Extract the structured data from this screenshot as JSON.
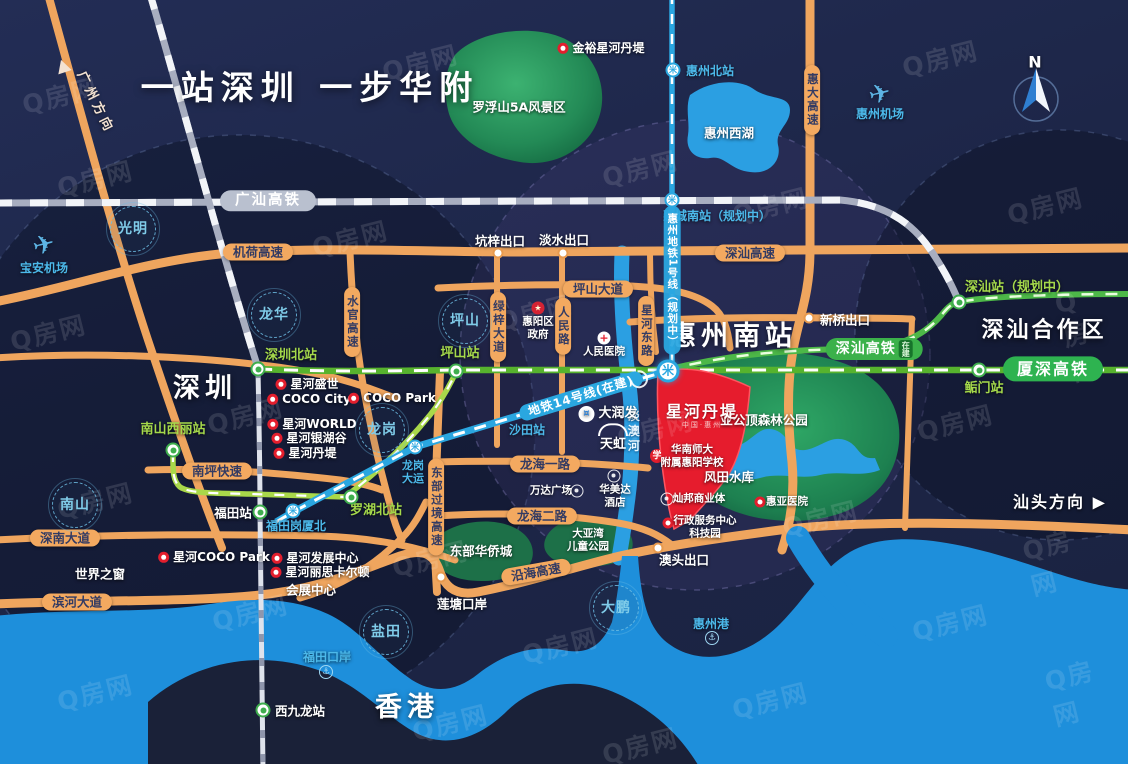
{
  "palette": {
    "background_navy": "#1d2648",
    "water_blue": "#1e8fdb",
    "land_dark": "#1a2138",
    "green_park": "#2e9e63",
    "road_orange": "#f3a960",
    "rail_gray": "#b9c0cf",
    "hsr_green": "#3bb14a",
    "metro_blue": "#2aa7e0",
    "project_red": "#e61c2d",
    "station_green_text": "#a5d94b",
    "station_blue_text": "#4cb9ea"
  },
  "watermark": {
    "text": "Q房网",
    "positions": [
      [
        60,
        95
      ],
      [
        420,
        62
      ],
      [
        940,
        58
      ],
      [
        640,
        168
      ],
      [
        95,
        178
      ],
      [
        770,
        205
      ],
      [
        1045,
        205
      ],
      [
        350,
        238
      ],
      [
        535,
        312
      ],
      [
        48,
        332
      ],
      [
        1085,
        335
      ],
      [
        245,
        415
      ],
      [
        655,
        428
      ],
      [
        955,
        422
      ],
      [
        95,
        500
      ],
      [
        430,
        558
      ],
      [
        820,
        518
      ],
      [
        1060,
        560
      ],
      [
        250,
        612
      ],
      [
        560,
        645
      ],
      [
        950,
        622
      ],
      [
        95,
        692
      ],
      [
        450,
        722
      ],
      [
        770,
        700
      ],
      [
        1075,
        692
      ],
      [
        640,
        745
      ]
    ]
  },
  "labels": [
    {
      "n": "main-title",
      "t": "title",
      "x": 310,
      "y": 88,
      "s": "一站深圳 一步华附"
    },
    {
      "n": "city-shenzhen",
      "t": "city",
      "x": 205,
      "y": 389,
      "s": "深圳"
    },
    {
      "n": "city-hongkong",
      "t": "city",
      "x": 407,
      "y": 708,
      "s": "香港"
    },
    {
      "n": "station-huizhounan-title",
      "t": "city",
      "x": 733,
      "y": 337,
      "s": "惠州南站"
    },
    {
      "n": "area-shenshan-coop",
      "t": "citysm",
      "x": 1044,
      "y": 331,
      "s": "深汕合作区"
    },
    {
      "n": "poi-window-of-world",
      "t": "w",
      "x": 100,
      "y": 574,
      "s": "世界之窗"
    },
    {
      "n": "poi-convention-center",
      "t": "w",
      "x": 311,
      "y": 590,
      "s": "会展中心"
    },
    {
      "n": "dir-shantou",
      "t": "wb",
      "x": 1060,
      "y": 502,
      "s": "汕头方向 ▶"
    },
    {
      "n": "compass-n-label",
      "t": "wb",
      "x": 1036,
      "y": 62,
      "s": "N"
    },
    {
      "n": "dir-guangzhou",
      "t": "dir",
      "x": 95,
      "y": 103,
      "rot": 64,
      "s": "广州方向"
    },
    {
      "n": "dir-guangzhou-arrow",
      "t": "sta",
      "ic": "tri",
      "x": 63,
      "y": 66
    },
    {
      "n": "area-luofushan",
      "t": "w",
      "x": 519,
      "y": 107,
      "s": "罗浮山5A风景区"
    },
    {
      "n": "area-yagongding",
      "t": "w",
      "x": 764,
      "y": 420,
      "s": "亚公顶森林公园"
    },
    {
      "n": "area-fengtian-reservoir",
      "t": "w",
      "x": 729,
      "y": 477,
      "s": "风田水库"
    },
    {
      "n": "area-oct-east",
      "t": "w",
      "x": 481,
      "y": 551,
      "s": "东部华侨城"
    },
    {
      "n": "area-dayawan-park",
      "t": "wsm",
      "x": 588,
      "y": 540,
      "s": "大亚湾",
      "s2": "儿童公园"
    },
    {
      "n": "lake-west-lake-label",
      "t": "w",
      "x": 729,
      "y": 133,
      "s": "惠州西湖"
    },
    {
      "n": "port-liantang-label",
      "t": "w",
      "x": 462,
      "y": 604,
      "s": "莲塘口岸"
    },
    {
      "n": "exit-kengzi-label",
      "t": "w",
      "x": 500,
      "y": 241,
      "s": "坑梓出口"
    },
    {
      "n": "exit-danshui-label",
      "t": "w",
      "x": 564,
      "y": 240,
      "s": "淡水出口"
    },
    {
      "n": "exit-xinqiao-label",
      "t": "w",
      "x": 845,
      "y": 320,
      "s": "新桥出口"
    },
    {
      "n": "exit-aotou-label",
      "t": "w",
      "x": 684,
      "y": 560,
      "s": "澳头出口"
    },
    {
      "n": "poi-renmin-hospital",
      "t": "wsm",
      "x": 604,
      "y": 352,
      "s": "人民医院"
    },
    {
      "n": "renmin-hospital-icon",
      "t": "sta",
      "ic": "cross",
      "x": 604,
      "y": 338
    },
    {
      "n": "poi-huiyang-gov",
      "t": "wsm",
      "x": 538,
      "y": 328,
      "s": "惠阳区",
      "s2": "政府"
    },
    {
      "n": "huiyang-gov-icon",
      "t": "sta",
      "ic": "gov",
      "x": 538,
      "y": 308
    },
    {
      "n": "poi-wanda-plaza",
      "t": "wsm",
      "x": 551,
      "y": 491,
      "s": "万达广场"
    },
    {
      "n": "wanda-plaza-icon",
      "t": "sta",
      "ic": "ring",
      "x": 577,
      "y": 491
    },
    {
      "n": "poi-ramada-hotel",
      "t": "wsm",
      "x": 615,
      "y": 496,
      "s": "华美达",
      "s2": "酒店"
    },
    {
      "n": "ramada-hotel-icon",
      "t": "sta",
      "ic": "ring",
      "x": 614,
      "y": 476
    },
    {
      "n": "canbang-icon",
      "t": "sta",
      "ic": "ring",
      "x": 667,
      "y": 499
    },
    {
      "n": "poi-canbang",
      "t": "wsm",
      "x": 699,
      "y": 499,
      "s": "灿邦商业体"
    },
    {
      "n": "admin-center-icon",
      "t": "sta",
      "ic": "pin",
      "x": 668,
      "y": 523
    },
    {
      "n": "poi-admin-center",
      "t": "wsm",
      "x": 705,
      "y": 527,
      "s": "行政服务中心",
      "s2": "科技园"
    },
    {
      "n": "poi-xinghe-cocopark",
      "t": "poi",
      "x": 214,
      "y": 557,
      "s": "星河COCO Park"
    },
    {
      "n": "poi-xinghe-dev-center",
      "t": "poi",
      "x": 315,
      "y": 558,
      "s": "星河发展中心"
    },
    {
      "n": "poi-xinghe-ritz",
      "t": "poi",
      "x": 320,
      "y": 572,
      "s": "星河丽思卡尔顿"
    },
    {
      "n": "poi-xinghe-shengshi",
      "t": "poi",
      "x": 307,
      "y": 384,
      "s": "星河盛世"
    },
    {
      "n": "poi-coco-city",
      "t": "poi",
      "x": 309,
      "y": 399,
      "s": "COCO City"
    },
    {
      "n": "poi-xinghe-world",
      "t": "poi",
      "x": 312,
      "y": 424,
      "s": "星河WORLD"
    },
    {
      "n": "poi-xinghe-yinhugu",
      "t": "poi",
      "x": 309,
      "y": 438,
      "s": "星河银湖谷"
    },
    {
      "n": "poi-xinghe-danti",
      "t": "poi",
      "x": 305,
      "y": 453,
      "s": "星河丹堤"
    },
    {
      "n": "poi-coco-park",
      "t": "poi",
      "x": 392,
      "y": 398,
      "s": "COCO Park"
    },
    {
      "n": "poi-jinyu-xinghe-danti",
      "t": "poi",
      "x": 601,
      "y": 48,
      "s": "金裕星河丹堤"
    },
    {
      "n": "school-icon",
      "t": "sta",
      "ic": "school",
      "x": 657,
      "y": 456
    },
    {
      "n": "poi-school",
      "t": "wsm",
      "x": 692,
      "y": 456,
      "s": "华南师大",
      "s2": "附属惠阳学校"
    },
    {
      "n": "huiya-hospital-icon",
      "t": "sta",
      "ic": "pin",
      "x": 760,
      "y": 502
    },
    {
      "n": "poi-huiya-hospital",
      "t": "wsm",
      "x": 787,
      "y": 502,
      "s": "惠亚医院"
    },
    {
      "n": "baoan-plane-icon",
      "t": "sta",
      "ic": "plane",
      "x": 44,
      "y": 246
    },
    {
      "n": "poi-baoan-airport",
      "t": "b",
      "x": 44,
      "y": 268,
      "s": "宝安机场"
    },
    {
      "n": "huizhou-plane-icon",
      "t": "sta",
      "ic": "plane",
      "x": 880,
      "y": 95
    },
    {
      "n": "poi-huizhou-airport",
      "t": "b",
      "x": 880,
      "y": 114,
      "s": "惠州机场"
    },
    {
      "n": "huizhoubei-metro-icon",
      "t": "sta",
      "ic": "metro",
      "x": 673,
      "y": 70
    },
    {
      "n": "sta-huizhoubei",
      "t": "b",
      "x": 710,
      "y": 71,
      "s": "惠州北站"
    },
    {
      "n": "sta-huichengnan",
      "t": "b",
      "x": 717,
      "y": 216,
      "s": "惠城南站（规划中）"
    },
    {
      "n": "futian-gangxiabei-icon",
      "t": "sta",
      "ic": "metro",
      "x": 293,
      "y": 511
    },
    {
      "n": "sta-futian-gangxiabei",
      "t": "b",
      "x": 296,
      "y": 526,
      "s": "福田岗厦北"
    },
    {
      "n": "shatian-icon",
      "t": "sta",
      "ic": "metro",
      "x": 527,
      "y": 413
    },
    {
      "n": "sta-shatian",
      "t": "b",
      "x": 527,
      "y": 430,
      "s": "沙田站"
    },
    {
      "n": "longgang-dayun-icon",
      "t": "sta",
      "ic": "metro",
      "x": 415,
      "y": 447
    },
    {
      "n": "sta-longgang-dayun",
      "t": "bsm",
      "x": 413,
      "y": 472,
      "s": "龙岗",
      "s2": "大运"
    },
    {
      "n": "river-danao-label",
      "t": "bv",
      "x": 633,
      "y": 432,
      "s": "淡澳河"
    },
    {
      "n": "port-futian-label",
      "t": "b",
      "x": 327,
      "y": 657,
      "s": "福田口岸"
    },
    {
      "n": "futian-port-icon",
      "t": "sta",
      "ic": "port",
      "x": 326,
      "y": 672
    },
    {
      "n": "port-huizhou-label",
      "t": "b",
      "x": 711,
      "y": 624,
      "s": "惠州港"
    },
    {
      "n": "huizhou-port-anchor-icon",
      "t": "sta",
      "ic": "port",
      "x": 712,
      "y": 638
    },
    {
      "n": "sta-shenzhenbei",
      "t": "g",
      "x": 291,
      "y": 356,
      "s": "深圳北站"
    },
    {
      "n": "shenzhenbei-icon",
      "t": "sta",
      "ic": "train",
      "x": 258,
      "y": 369
    },
    {
      "n": "sta-pingshan",
      "t": "g",
      "x": 460,
      "y": 354,
      "s": "坪山站"
    },
    {
      "n": "pingshan-icon",
      "t": "sta",
      "ic": "train",
      "x": 456,
      "y": 371
    },
    {
      "n": "sta-nanshan-xili",
      "t": "g",
      "x": 173,
      "y": 430,
      "s": "南山西丽站"
    },
    {
      "n": "nanshan-xili-icon",
      "t": "sta",
      "ic": "train",
      "x": 173,
      "y": 450
    },
    {
      "n": "sta-luohubei",
      "t": "g",
      "x": 376,
      "y": 511,
      "s": "罗湖北站"
    },
    {
      "n": "luohubei-icon",
      "t": "sta",
      "ic": "train",
      "x": 351,
      "y": 497
    },
    {
      "n": "sta-futian",
      "t": "w",
      "x": 233,
      "y": 513,
      "s": "福田站"
    },
    {
      "n": "futian-icon",
      "t": "sta",
      "ic": "train",
      "x": 260,
      "y": 512
    },
    {
      "n": "sta-xijiulong",
      "t": "w",
      "x": 300,
      "y": 711,
      "s": "西九龙站"
    },
    {
      "n": "xijiulong-icon",
      "t": "sta",
      "ic": "train",
      "x": 263,
      "y": 710
    },
    {
      "n": "sta-shenshan-planned",
      "t": "g",
      "x": 1017,
      "y": 288,
      "s": "深汕站（规划中）"
    },
    {
      "n": "shenshan-station-icon",
      "t": "sta",
      "ic": "train",
      "x": 959,
      "y": 302
    },
    {
      "n": "sta-houmen",
      "t": "g",
      "x": 984,
      "y": 389,
      "s": "鲘门站"
    },
    {
      "n": "houmen-icon",
      "t": "sta",
      "ic": "train",
      "x": 979,
      "y": 370
    },
    {
      "n": "pill-shenshan-hsr",
      "t": "pgr",
      "x": 874,
      "y": 349,
      "s": "深汕高铁",
      "tag": "在建"
    },
    {
      "n": "pill-xiashen-hsr",
      "t": "pgr2",
      "x": 1053,
      "y": 369,
      "s": "厦深高铁"
    },
    {
      "n": "pill-guangshan-hsr",
      "t": "pg",
      "x": 268,
      "y": 201,
      "s": "广汕高铁"
    },
    {
      "n": "pill-jihe-expwy",
      "t": "po",
      "x": 258,
      "y": 252,
      "s": "机荷高速"
    },
    {
      "n": "pill-shenshan-expwy",
      "t": "po",
      "x": 750,
      "y": 253,
      "s": "深汕高速"
    },
    {
      "n": "pill-pingshan-ave",
      "t": "po",
      "x": 598,
      "y": 289,
      "s": "坪山大道"
    },
    {
      "n": "pill-longhai-1st-rd",
      "t": "po",
      "x": 545,
      "y": 464,
      "s": "龙海一路"
    },
    {
      "n": "pill-longhai-2nd-rd",
      "t": "po",
      "x": 542,
      "y": 516,
      "s": "龙海二路"
    },
    {
      "n": "pill-nanping-expwy",
      "t": "po",
      "x": 217,
      "y": 471,
      "s": "南坪快速"
    },
    {
      "n": "pill-shennan-ave",
      "t": "po",
      "x": 65,
      "y": 538,
      "s": "深南大道"
    },
    {
      "n": "pill-binhe-ave",
      "t": "po",
      "x": 77,
      "y": 602,
      "s": "滨河大道"
    },
    {
      "n": "pill-yanhai-expwy",
      "t": "po",
      "x": 536,
      "y": 572,
      "rot": -10,
      "s": "沿海高速"
    },
    {
      "n": "pill-huida-expwy",
      "t": "pov",
      "x": 812,
      "y": 100,
      "s": "惠大高速"
    },
    {
      "n": "pill-shuiguan-expwy",
      "t": "pov",
      "x": 352,
      "y": 322,
      "s": "水官高速"
    },
    {
      "n": "pill-lvzi-ave",
      "t": "pov",
      "x": 498,
      "y": 327,
      "s": "绿梓大道"
    },
    {
      "n": "pill-renmin-rd",
      "t": "pov",
      "x": 563,
      "y": 326,
      "s": "人民路"
    },
    {
      "n": "pill-xinghe-east-rd",
      "t": "pov",
      "x": 646,
      "y": 331,
      "s": "星河东路"
    },
    {
      "n": "pill-east-transit-expwy",
      "t": "pov",
      "x": 436,
      "y": 507,
      "s": "东部过境高速"
    },
    {
      "n": "pill-huizhou-metro-line1",
      "t": "pmv",
      "x": 672,
      "y": 280,
      "s": "惠州地铁1号线（规划中）"
    },
    {
      "n": "lbl-metro-line14",
      "t": "ll",
      "x": 581,
      "y": 396,
      "rot": -17,
      "s": "地铁14号线(在建)"
    },
    {
      "n": "badge-guangming",
      "t": "cb",
      "x": 133,
      "y": 229,
      "s": "光明"
    },
    {
      "n": "badge-longhua",
      "t": "cb",
      "x": 274,
      "y": 315,
      "s": "龙华"
    },
    {
      "n": "badge-pingshan",
      "t": "cb",
      "x": 465,
      "y": 321,
      "s": "坪山"
    },
    {
      "n": "badge-longgang",
      "t": "cb",
      "x": 382,
      "y": 430,
      "s": "龙岗"
    },
    {
      "n": "badge-nanshan",
      "t": "cb",
      "x": 75,
      "y": 505,
      "s": "南山"
    },
    {
      "n": "badge-yantian",
      "t": "cb",
      "x": 386,
      "y": 632,
      "s": "盐田"
    },
    {
      "n": "badge-dapeng",
      "t": "cb",
      "x": 616,
      "y": 608,
      "s": "大鹏"
    },
    {
      "n": "exit-kengzi-dot",
      "t": "sta",
      "ic": "dot",
      "x": 498,
      "y": 253
    },
    {
      "n": "exit-danshui-dot",
      "t": "sta",
      "ic": "dot",
      "x": 563,
      "y": 253
    },
    {
      "n": "exit-xinqiao-dot",
      "t": "sta",
      "ic": "dot",
      "x": 809,
      "y": 318
    },
    {
      "n": "exit-aotou-dot",
      "t": "sta",
      "ic": "dot",
      "x": 658,
      "y": 548
    },
    {
      "n": "port-liantang-dot",
      "t": "sta",
      "ic": "dot",
      "x": 441,
      "y": 577
    },
    {
      "n": "huizhounan-interchange-icon",
      "t": "sta",
      "ic": "metroL",
      "x": 668,
      "y": 371
    },
    {
      "n": "line1-rail-crossing-icon",
      "t": "sta",
      "ic": "metro",
      "x": 672,
      "y": 200
    },
    {
      "n": "logo-rtmart",
      "t": "lgrt",
      "x": 608,
      "y": 414,
      "s": "大润发"
    },
    {
      "n": "logo-tianhong",
      "t": "lgth",
      "x": 613,
      "y": 438,
      "s": "天虹"
    },
    {
      "n": "logo-project",
      "t": "lgred",
      "x": 702,
      "y": 416,
      "s": "星河丹堤",
      "s2": "中国·惠州"
    }
  ]
}
